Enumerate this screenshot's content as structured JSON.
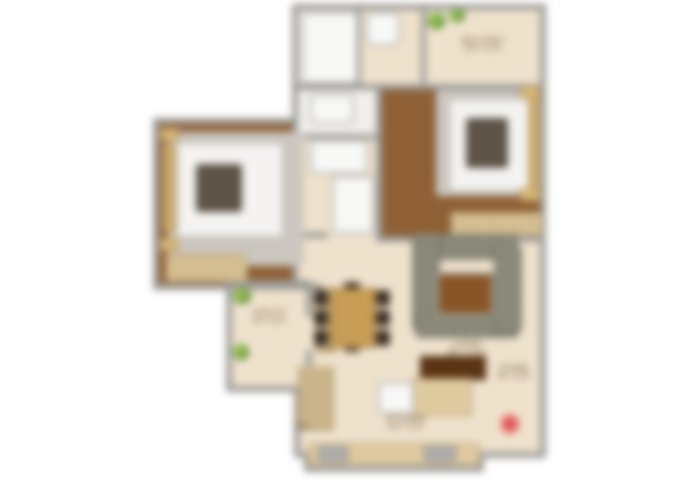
{
  "title": "Apartment 2BHK floor plan (blurred render)",
  "labels": {
    "balcony_top": {
      "line1": "BALCONY",
      "line2": "10'0\" X 4'0\""
    },
    "utility": {
      "line1": "UTILITY",
      "line2": "6'6\" X 9'0\""
    },
    "living": {
      "line1": "LIVING",
      "line2": "16'6\" X 11'0\""
    },
    "kitchen": {
      "line1": "KITCHEN",
      "line2": "10'0\" X 8'0\""
    },
    "store": {
      "line1": "STORE",
      "line2": "4'6\" X 4'0\""
    },
    "ref": {
      "line1": "REF."
    }
  },
  "colors": {
    "floor_beige": "#efe2cd",
    "wood_brown": "#8d5c2e",
    "wall_gray": "#9c9a97",
    "wardrobe_tan": "#dcc79c",
    "sofa_gray": "#8e8d7d",
    "dining_table_wood": "#d2a65c",
    "plant_green": "#76a43c",
    "marker_red": "#e25858",
    "background": "#ffffff"
  },
  "icons": {
    "plant": "plant-icon",
    "marker": "red-location-dot"
  }
}
